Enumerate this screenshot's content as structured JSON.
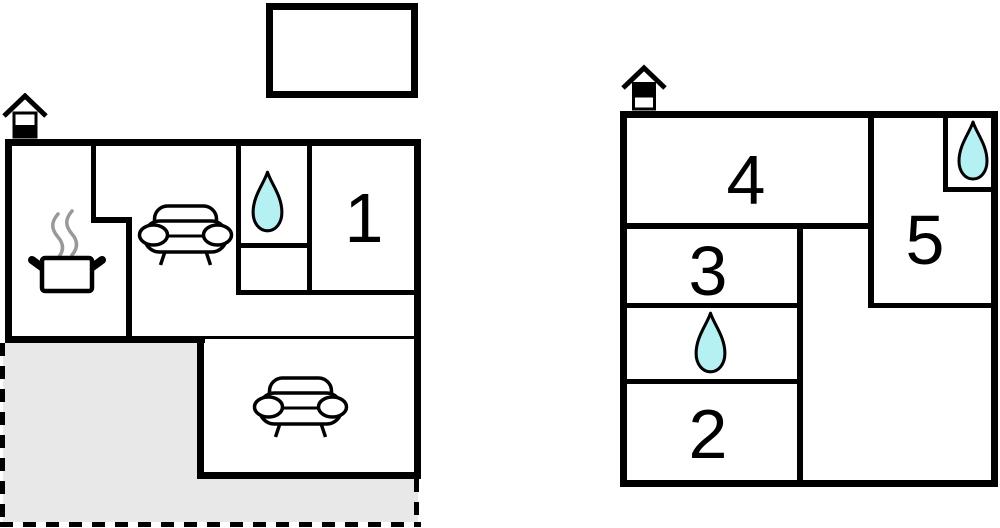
{
  "palette": {
    "wall": "#000000",
    "water_drop_fill": "#b5f1f3",
    "terrace_fill": "#e8e8e8",
    "steam_gray": "#999999",
    "background": "#ffffff"
  },
  "left_plan": {
    "rooms": [
      {
        "label": "1"
      }
    ],
    "features": [
      "chimney-icon",
      "kitchen-pot-icon",
      "sofa-icon",
      "water-drop-icon",
      "sofa-icon",
      "terrace-area",
      "annex-outline"
    ]
  },
  "right_plan": {
    "rooms": [
      {
        "label": "4"
      },
      {
        "label": "5"
      },
      {
        "label": "3"
      },
      {
        "label": "2"
      }
    ],
    "features": [
      "chimney-icon",
      "water-drop-icon",
      "water-drop-icon"
    ]
  }
}
